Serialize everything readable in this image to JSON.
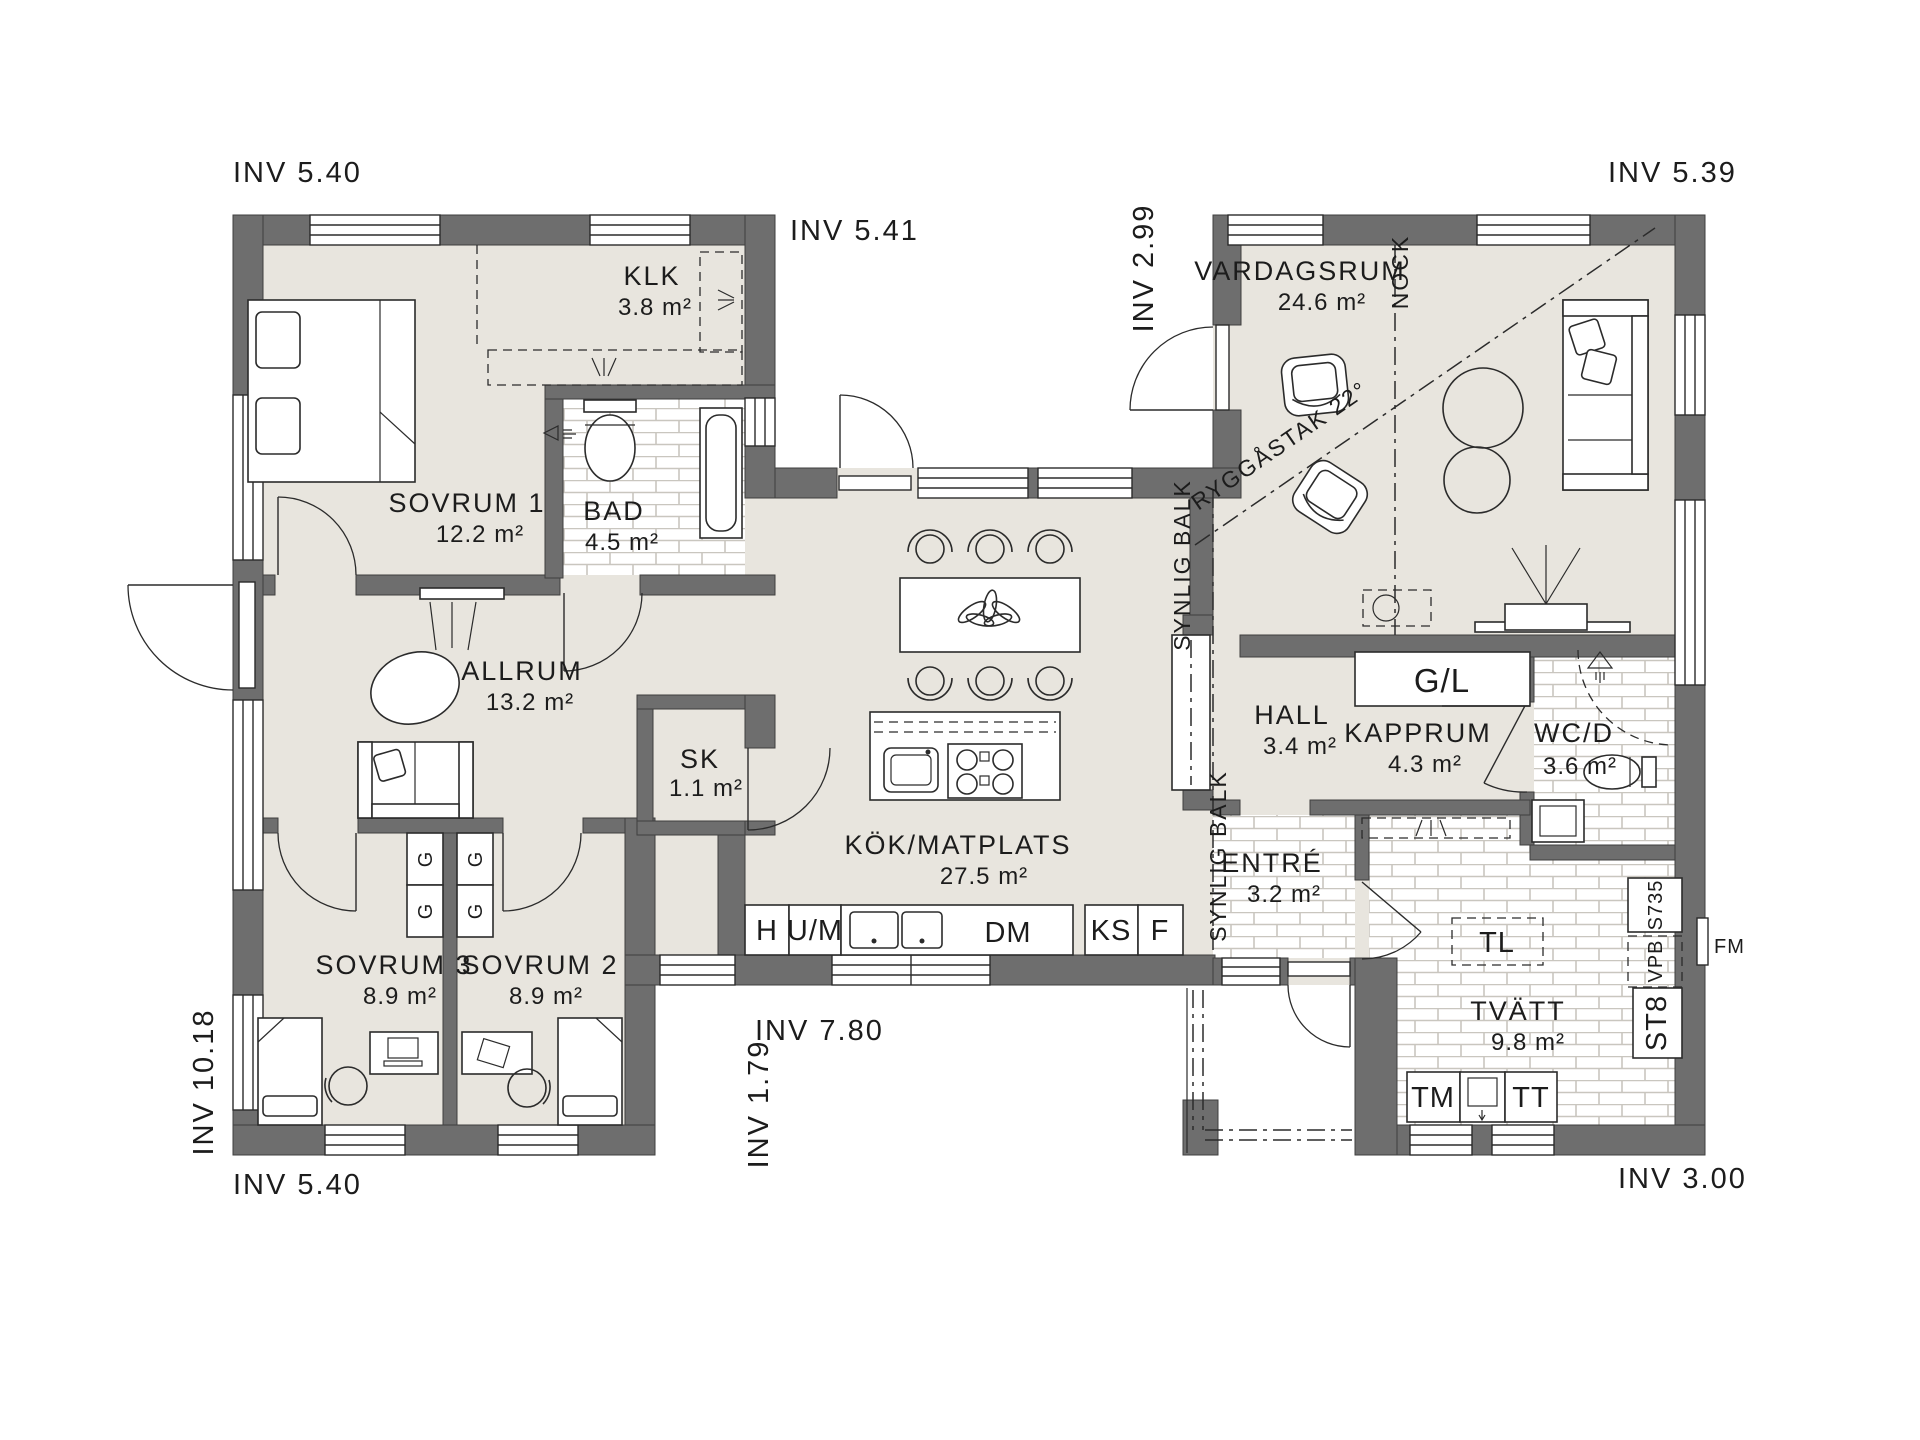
{
  "drawing": {
    "dimensions": {
      "top_left": "INV 5.40",
      "top_middle": "INV 5.41",
      "connector_top": "INV 2.99",
      "top_right": "INV 5.39",
      "left": "INV 10.18",
      "bottom_left": "INV 5.40",
      "bottom_middle": "INV 7.80",
      "connector_bottom": "INV 1.79",
      "bottom_right": "INV 3.00"
    },
    "roof": {
      "nock": "NOCK",
      "ridge": "RYGGÅSTAK 22°",
      "beam": "SYNLIG BALK"
    },
    "rooms": {
      "sovrum1": {
        "name": "SOVRUM 1",
        "area": "12.2 m²"
      },
      "klk": {
        "name": "KLK",
        "area": "3.8 m²"
      },
      "bad": {
        "name": "BAD",
        "area": "4.5 m²"
      },
      "allrum": {
        "name": "ALLRUM",
        "area": "13.2 m²"
      },
      "sk": {
        "name": "SK",
        "area": "1.1 m²"
      },
      "sovrum3": {
        "name": "SOVRUM 3",
        "area": "8.9 m²"
      },
      "sovrum2": {
        "name": "SOVRUM 2",
        "area": "8.9 m²"
      },
      "kok": {
        "name": "KÖK/MATPLATS",
        "area": "27.5 m²"
      },
      "vardagsrum": {
        "name": "VARDAGSRUM",
        "area": "24.6 m²"
      },
      "hall": {
        "name": "HALL",
        "area": "3.4 m²"
      },
      "kapprum": {
        "name": "KAPPRUM",
        "area": "4.3 m²"
      },
      "wcd": {
        "name": "WC/D",
        "area": "3.6 m²"
      },
      "entre": {
        "name": "ENTRÉ",
        "area": "3.2 m²"
      },
      "tvatt": {
        "name": "TVÄTT",
        "area": "9.8 m²"
      }
    },
    "appliances": {
      "h": "H",
      "um": "U/M",
      "dm": "DM",
      "ks": "KS",
      "f": "F",
      "tm": "TM",
      "tt": "TT",
      "tl": "TL",
      "gl": "G/L",
      "g": "G",
      "st8": "ST8",
      "vpb": "VPB",
      "s735": "S735",
      "fm": "FM"
    },
    "colors": {
      "wall": "#6e6e6e",
      "floor": "#e8e5de",
      "tile_line": "#cfccc4"
    }
  }
}
